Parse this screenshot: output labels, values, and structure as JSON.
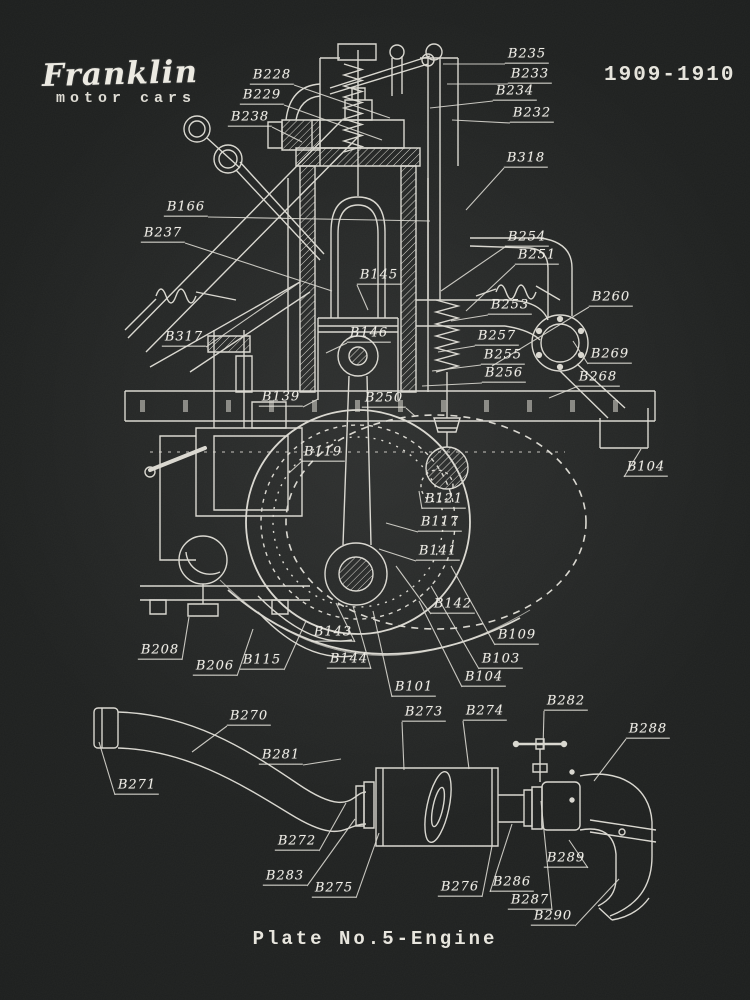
{
  "title_block": {
    "brand": "Franklin",
    "brand_sub": "motor cars",
    "years": "1909-1910",
    "caption": "Plate No.5-Engine"
  },
  "colors": {
    "background": "#1d1f1e",
    "line": "#e9e7df",
    "label_text": "#efede6"
  },
  "diagram": {
    "description": "Franklin motor cars engine cross-section patent drawing with exhaust assembly detail",
    "labels": [
      {
        "t": "B228",
        "x": 272,
        "y": 77,
        "ex": 390,
        "ey": 118
      },
      {
        "t": "B229",
        "x": 262,
        "y": 97,
        "ex": 382,
        "ey": 140
      },
      {
        "t": "B238",
        "x": 250,
        "y": 119,
        "ex": 302,
        "ey": 142
      },
      {
        "t": "B235",
        "x": 527,
        "y": 56,
        "ex": 443,
        "ey": 64
      },
      {
        "t": "B233",
        "x": 530,
        "y": 76,
        "ex": 447,
        "ey": 84
      },
      {
        "t": "B234",
        "x": 515,
        "y": 93,
        "ex": 430,
        "ey": 108
      },
      {
        "t": "B232",
        "x": 532,
        "y": 115,
        "ex": 452,
        "ey": 120
      },
      {
        "t": "B318",
        "x": 526,
        "y": 160,
        "ex": 466,
        "ey": 210
      },
      {
        "t": "B166",
        "x": 186,
        "y": 209,
        "ex": 430,
        "ey": 221
      },
      {
        "t": "B237",
        "x": 163,
        "y": 235,
        "ex": 332,
        "ey": 291
      },
      {
        "t": "B317",
        "x": 184,
        "y": 339,
        "ex": 300,
        "ey": 282
      },
      {
        "t": "B254",
        "x": 527,
        "y": 239,
        "ex": 441,
        "ey": 291
      },
      {
        "t": "B251",
        "x": 537,
        "y": 257,
        "ex": 466,
        "ey": 311
      },
      {
        "t": "B253",
        "x": 510,
        "y": 307,
        "ex": 451,
        "ey": 321
      },
      {
        "t": "B260",
        "x": 611,
        "y": 299,
        "ex": 492,
        "ey": 366
      },
      {
        "t": "B257",
        "x": 497,
        "y": 338,
        "ex": 438,
        "ey": 352
      },
      {
        "t": "B255",
        "x": 503,
        "y": 357,
        "ex": 432,
        "ey": 371
      },
      {
        "t": "B256",
        "x": 504,
        "y": 375,
        "ex": 422,
        "ey": 386
      },
      {
        "t": "B269",
        "x": 610,
        "y": 356,
        "ex": 573,
        "ey": 341
      },
      {
        "t": "B268",
        "x": 598,
        "y": 379,
        "ex": 549,
        "ey": 398
      },
      {
        "t": "B145",
        "x": 379,
        "y": 277,
        "ex": 368,
        "ey": 310
      },
      {
        "t": "B146",
        "x": 369,
        "y": 335,
        "ex": 326,
        "ey": 353
      },
      {
        "t": "B139",
        "x": 281,
        "y": 399,
        "ex": 318,
        "ey": 399
      },
      {
        "t": "B250",
        "x": 384,
        "y": 400,
        "ex": 415,
        "ey": 416
      },
      {
        "t": "B119",
        "x": 323,
        "y": 454,
        "ex": 289,
        "ey": 473
      },
      {
        "t": "B121",
        "x": 444,
        "y": 501,
        "ex": 419,
        "ey": 491
      },
      {
        "t": "B117",
        "x": 440,
        "y": 524,
        "ex": 386,
        "ey": 523
      },
      {
        "t": "B141",
        "x": 438,
        "y": 553,
        "ex": 379,
        "ey": 549
      },
      {
        "t": "B142",
        "x": 453,
        "y": 606,
        "ex": 396,
        "ey": 566
      },
      {
        "t": "B143",
        "x": 333,
        "y": 634,
        "ex": 336,
        "ey": 603
      },
      {
        "t": "B144",
        "x": 349,
        "y": 661,
        "ex": 353,
        "ey": 606
      },
      {
        "t": "B101",
        "x": 414,
        "y": 689,
        "ex": 373,
        "ey": 611
      },
      {
        "t": "B115",
        "x": 262,
        "y": 662,
        "ex": 306,
        "ey": 621
      },
      {
        "t": "B206",
        "x": 215,
        "y": 668,
        "ex": 253,
        "ey": 629
      },
      {
        "t": "B208",
        "x": 160,
        "y": 652,
        "ex": 189,
        "ey": 617
      },
      {
        "t": "B109",
        "x": 517,
        "y": 637,
        "ex": 451,
        "ey": 566
      },
      {
        "t": "B103",
        "x": 501,
        "y": 661,
        "ex": 431,
        "ey": 586
      },
      {
        "t": "B104",
        "x": 484,
        "y": 679,
        "ex": 419,
        "ey": 601
      },
      {
        "t": "B104",
        "x": 646,
        "y": 469,
        "ex": 641,
        "ey": 449
      },
      {
        "t": "B282",
        "x": 566,
        "y": 703,
        "ex": 543,
        "ey": 749
      },
      {
        "t": "B270",
        "x": 249,
        "y": 718,
        "ex": 192,
        "ey": 752
      },
      {
        "t": "B271",
        "x": 137,
        "y": 787,
        "ex": 99,
        "ey": 742
      },
      {
        "t": "B281",
        "x": 281,
        "y": 757,
        "ex": 341,
        "ey": 759
      },
      {
        "t": "B272",
        "x": 297,
        "y": 843,
        "ex": 346,
        "ey": 803
      },
      {
        "t": "B283",
        "x": 285,
        "y": 878,
        "ex": 355,
        "ey": 819
      },
      {
        "t": "B275",
        "x": 334,
        "y": 890,
        "ex": 379,
        "ey": 833
      },
      {
        "t": "B273",
        "x": 424,
        "y": 714,
        "ex": 404,
        "ey": 770
      },
      {
        "t": "B274",
        "x": 485,
        "y": 713,
        "ex": 469,
        "ey": 769
      },
      {
        "t": "B288",
        "x": 648,
        "y": 731,
        "ex": 594,
        "ey": 781
      },
      {
        "t": "B289",
        "x": 566,
        "y": 860,
        "ex": 569,
        "ey": 840
      },
      {
        "t": "B276",
        "x": 460,
        "y": 889,
        "ex": 492,
        "ey": 846
      },
      {
        "t": "B286",
        "x": 512,
        "y": 884,
        "ex": 512,
        "ey": 824
      },
      {
        "t": "B287",
        "x": 530,
        "y": 902,
        "ex": 541,
        "ey": 801
      },
      {
        "t": "B290",
        "x": 553,
        "y": 918,
        "ex": 619,
        "ey": 879
      }
    ]
  }
}
